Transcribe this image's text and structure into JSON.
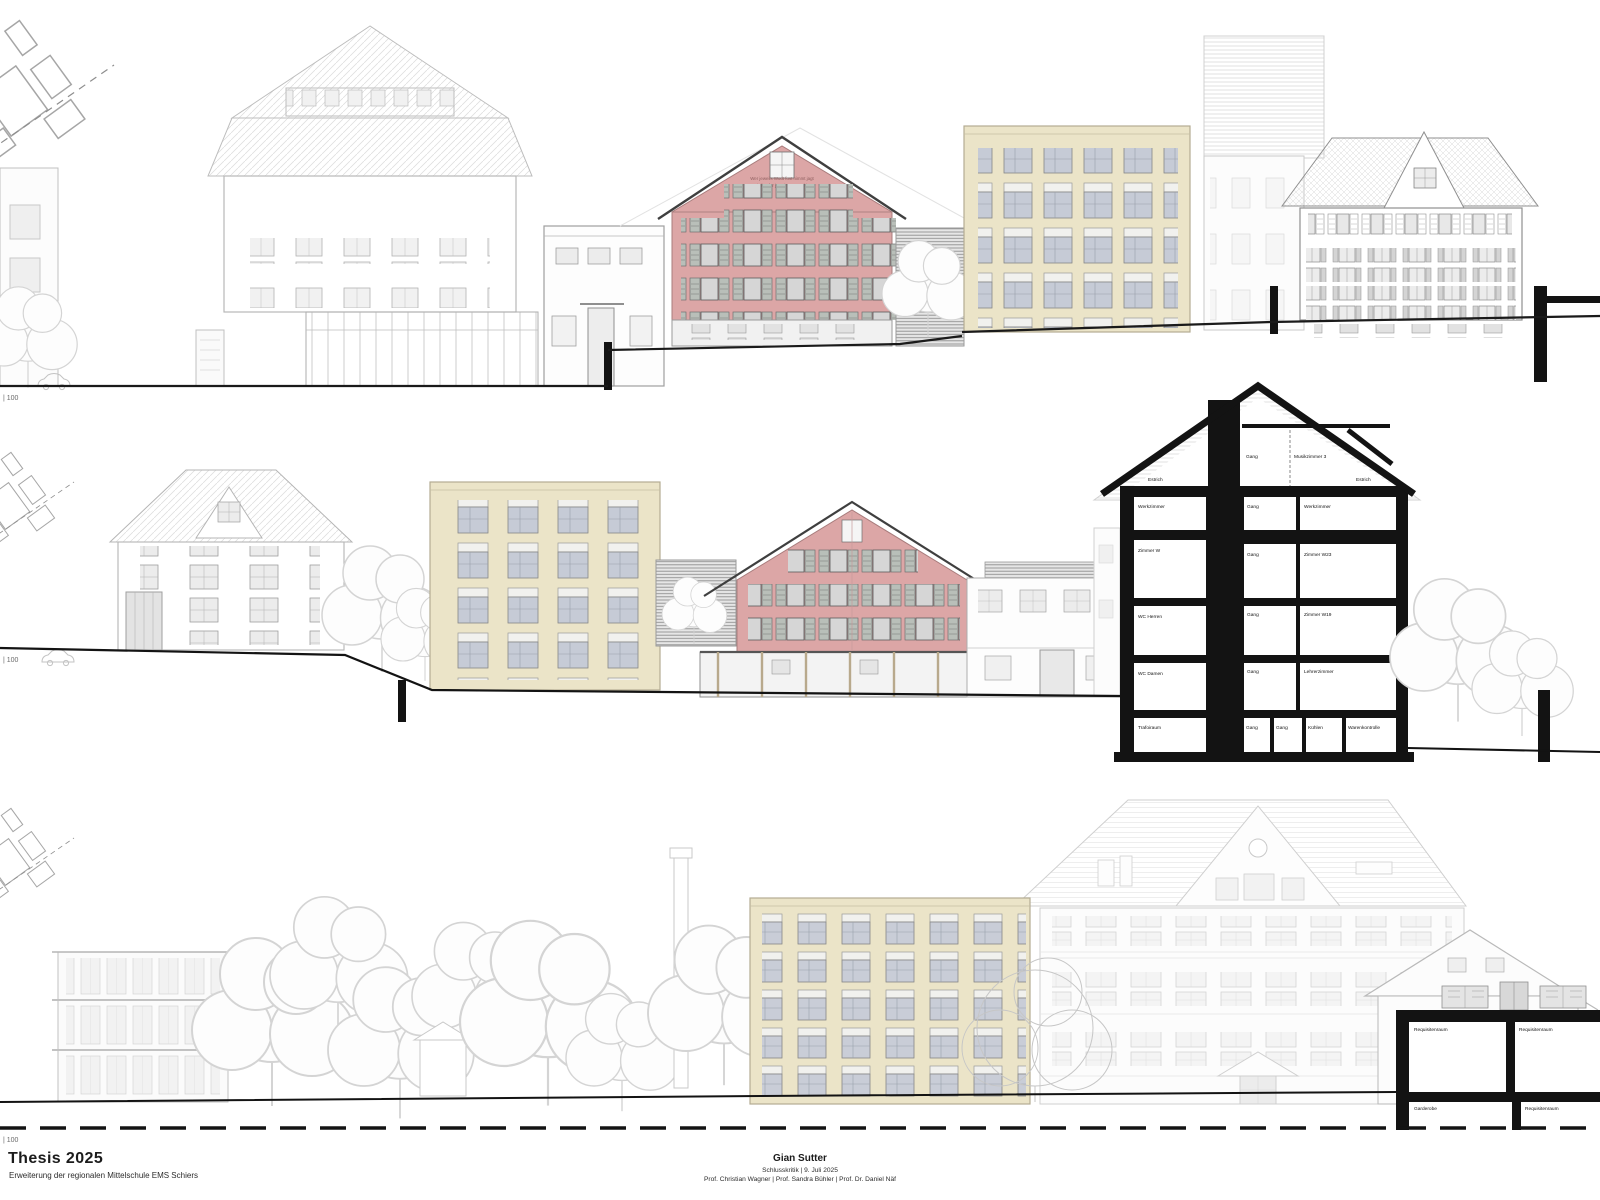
{
  "title_block": {
    "title": "Thesis 2025",
    "subtitle": "Erweiterung der regionalen Mittelschule EMS Schiers",
    "author": "Gian Sutter",
    "event_line": "Schlusskritik | 9. Juli 2025",
    "professors_line": "Prof. Christian Wagner | Prof. Sandra Bühler | Prof. Dr. Daniel Näf"
  },
  "scale_labels": {
    "top": "| 100",
    "middle": "| 100",
    "bottom": "| 100"
  },
  "red_house_inscription": {
    "line1": "Wer jeweils Wodt fust nimmt jagt",
    "line2": "zweit lint, fur jetzt im Zum Ghieter"
  },
  "section_rooms": {
    "attic": [
      "Estrich",
      "Gang",
      "Musikzimmer 3",
      "Estrich"
    ],
    "floor4": [
      "Werkzimmer",
      "Gang",
      "Werkzimmer"
    ],
    "floor3": [
      "Zimmer W",
      "Gang",
      "Zimmer W23"
    ],
    "floor2": [
      "WC Herren",
      "Gang",
      "Zimmer W19"
    ],
    "floor1": [
      "WC Damen",
      "Gang",
      "Lehrerzimmer"
    ],
    "floor0": [
      "Trafoiraum",
      "Gang",
      "Gang",
      "Kühlen",
      "Warenkontrolle"
    ]
  },
  "stage_section_rooms": [
    "Requisitenraum",
    "Requisitenraum",
    "Garderobe",
    "Requisitenraum"
  ],
  "colors": {
    "red_facade": "#dca6a6",
    "cream_facade": "#ebe4c8",
    "section_poche": "#131313",
    "lineart_grey": "#c9c9c9",
    "paper": "#ffffff"
  }
}
